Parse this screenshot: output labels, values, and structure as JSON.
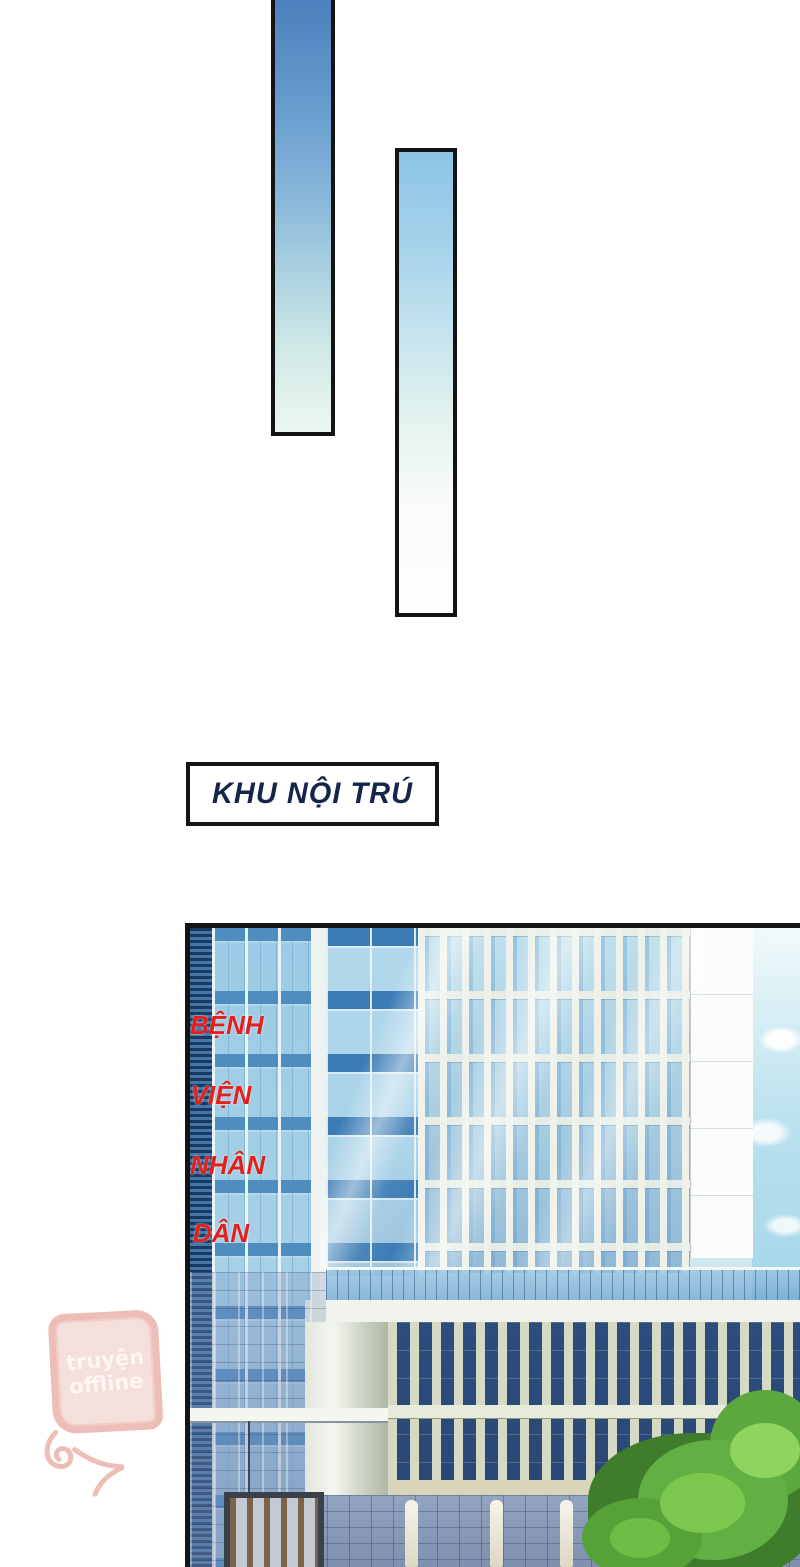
{
  "page": {
    "width_px": 800,
    "height_px": 1567,
    "background_color": "#ffffff",
    "type": "comic-page"
  },
  "caption_box": {
    "text": "KHU NỘI TRÚ",
    "text_color": "#16254a",
    "border_color": "#141414",
    "background_color": "#ffffff"
  },
  "hospital_sign": {
    "words": [
      "BỆNH",
      "VIỆN",
      "NHÂN",
      "DÂN"
    ],
    "text_color": "#e3201c",
    "panel_color": "#fcfdfb"
  },
  "watermark": {
    "line1": "truyện",
    "line2": "offline",
    "color": "#ecb7b0"
  },
  "transition_bars": {
    "count": 2,
    "border_color": "#141414",
    "gradient_top_color": "#4f7fbd",
    "gradient_bottom_color": "#fefefe"
  },
  "panel": {
    "border_color": "#141414",
    "scene": "hospital buildings with glass towers, lower colonnade wing, entrance and green tree",
    "sky_color": "#b9e0ee",
    "tree_color": "#62b044"
  }
}
